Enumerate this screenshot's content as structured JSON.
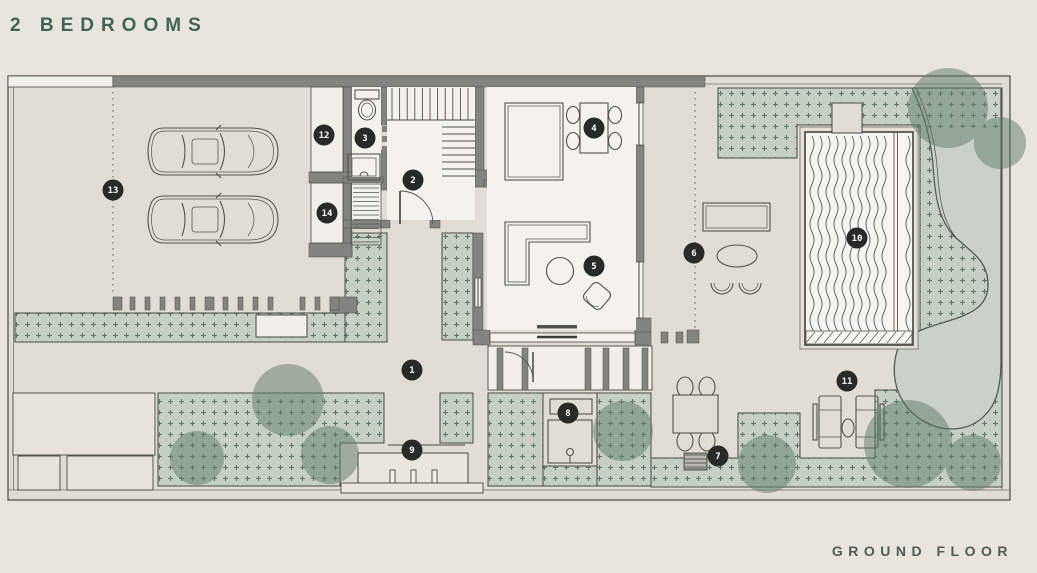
{
  "title": "2 BEDROOMS",
  "floor_label": "GROUND FLOOR",
  "markers": [
    {
      "label": "1",
      "x": 412,
      "y": 370
    },
    {
      "label": "2",
      "x": 413,
      "y": 180
    },
    {
      "label": "3",
      "x": 365,
      "y": 138
    },
    {
      "label": "4",
      "x": 594,
      "y": 128
    },
    {
      "label": "5",
      "x": 594,
      "y": 266
    },
    {
      "label": "6",
      "x": 694,
      "y": 253
    },
    {
      "label": "7",
      "x": 718,
      "y": 456
    },
    {
      "label": "8",
      "x": 568,
      "y": 413
    },
    {
      "label": "9",
      "x": 412,
      "y": 450
    },
    {
      "label": "10",
      "x": 857,
      "y": 238
    },
    {
      "label": "11",
      "x": 847,
      "y": 381
    },
    {
      "label": "12",
      "x": 324,
      "y": 135
    },
    {
      "label": "13",
      "x": 113,
      "y": 190
    },
    {
      "label": "14",
      "x": 327,
      "y": 213
    }
  ],
  "colors": {
    "title": "#3e6454",
    "floor_label": "#4e5c54",
    "marker_bg": "#262b27",
    "marker_text": "#ffffff",
    "planting_fill": "#c5cfc4",
    "planting_dot": "#5c7767",
    "tree": "#5e7c68",
    "water": "#c9d1c8",
    "wall": "#83837f",
    "page_background": "#e9e4dc",
    "plan_floor": "#e2ddd4",
    "interior": "#f4f2ec"
  }
}
